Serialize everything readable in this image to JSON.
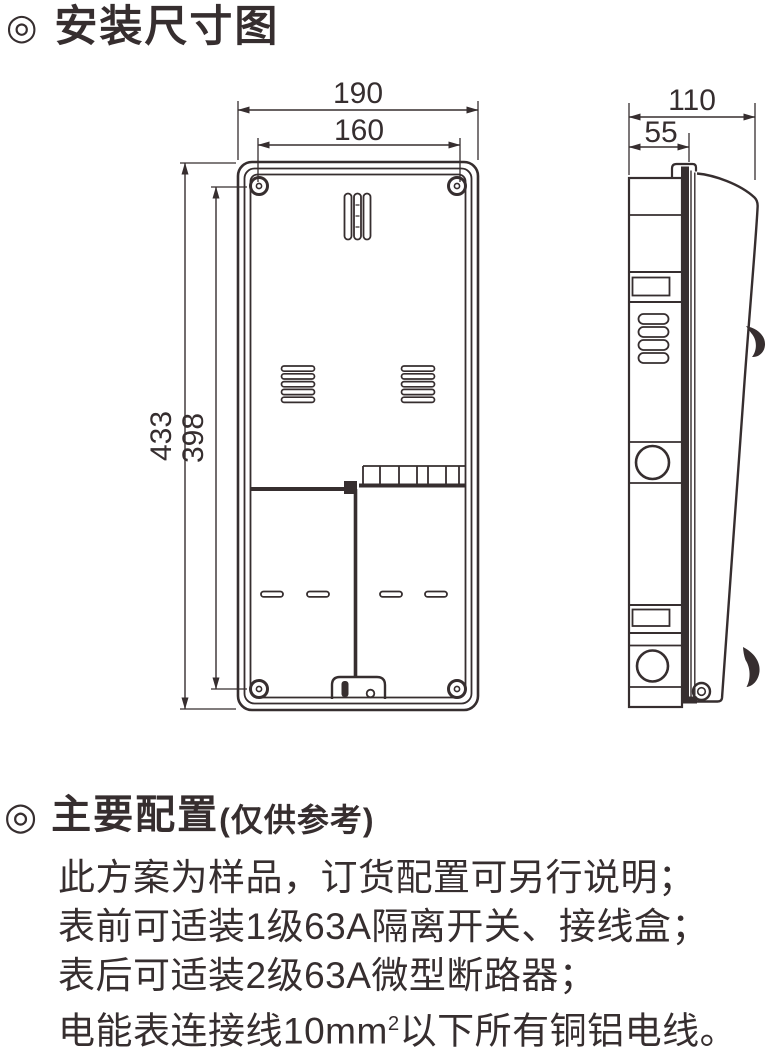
{
  "colors": {
    "ink": "#362e2f",
    "bg": "#ffffff"
  },
  "sections": {
    "installation": {
      "bullet": "◎",
      "title": "安装尺寸图"
    },
    "configuration": {
      "bullet": "◎",
      "title": "主要配置",
      "title_note": "(仅供参考)",
      "lines": [
        "此方案为样品，订货配置可另行说明；",
        "表前可适装1级63A隔离开关、接线盒；",
        "表后可适装2级63A微型断路器；"
      ],
      "last_line": {
        "prefix": "电能表连接线10mm",
        "superscript": "2",
        "suffix": "以下所有铜铝电线。"
      }
    }
  },
  "drawing": {
    "dimensions": {
      "front_outer_width": "190",
      "front_mount_width": "160",
      "front_outer_height": "433",
      "front_mount_height": "398",
      "side_total_depth": "110",
      "side_body_depth": "55"
    }
  }
}
